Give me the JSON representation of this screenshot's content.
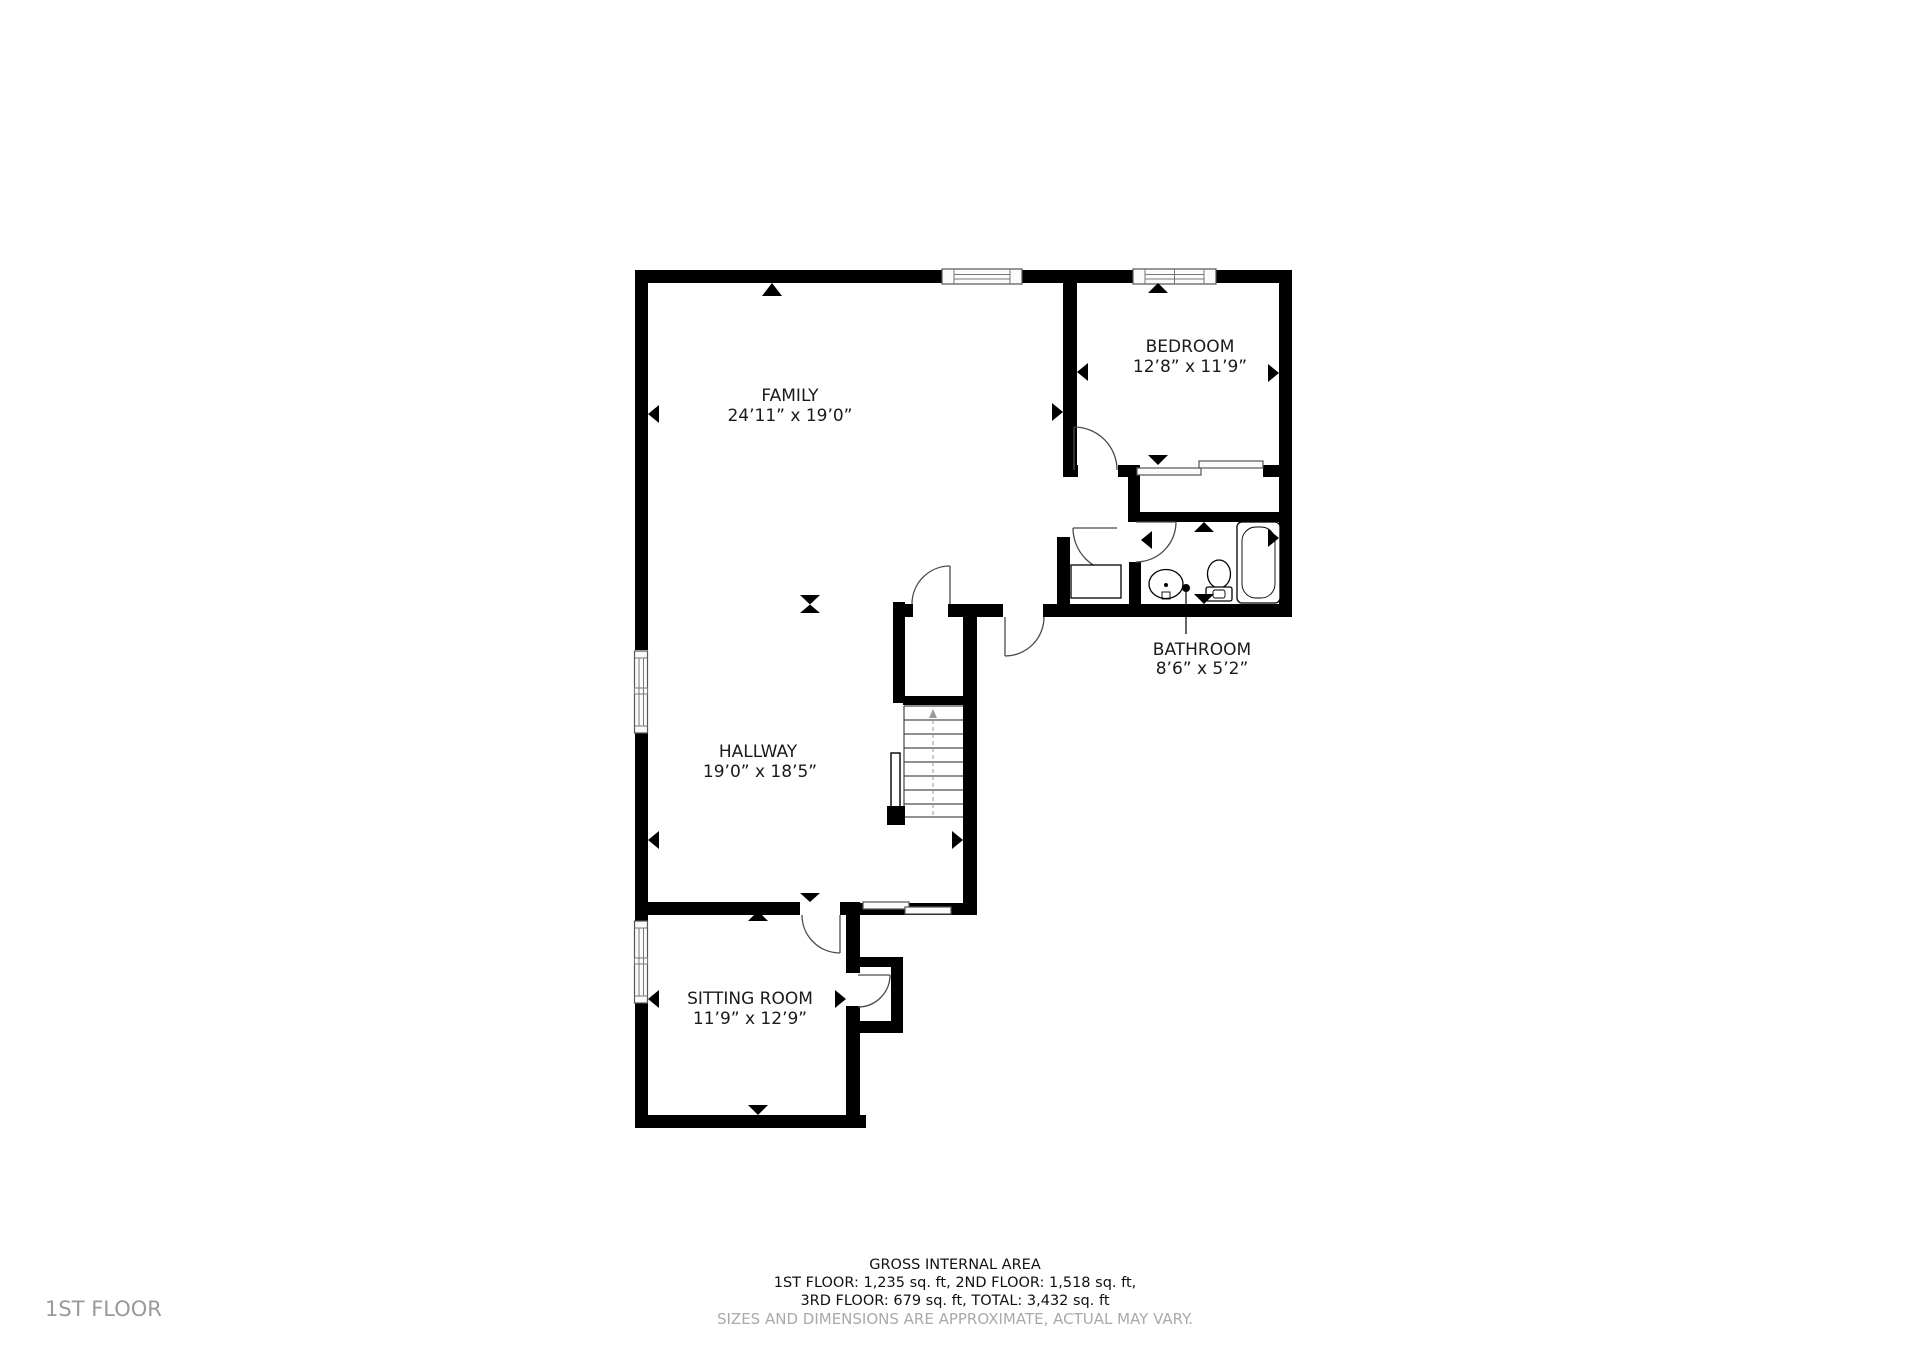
{
  "floor_label": "1ST FLOOR",
  "rooms": {
    "family": {
      "name": "FAMILY",
      "dims": "24’11” x 19’0”"
    },
    "bedroom": {
      "name": "BEDROOM",
      "dims": "12’8” x 11’9”"
    },
    "bathroom": {
      "name": "BATHROOM",
      "dims": "8’6” x 5’2”"
    },
    "hallway": {
      "name": "HALLWAY",
      "dims": "19’0” x 18’5”"
    },
    "sitting": {
      "name": "SITTING ROOM",
      "dims": "11’9” x 12’9”"
    }
  },
  "footer": {
    "line1": "GROSS INTERNAL AREA",
    "line2": "1ST FLOOR: 1,235 sq. ft, 2ND FLOOR: 1,518 sq. ft,",
    "line3": "3RD FLOOR: 679 sq. ft, TOTAL: 3,432 sq. ft",
    "disclaimer": "SIZES AND DIMENSIONS ARE APPROXIMATE, ACTUAL MAY VARY."
  },
  "colors": {
    "wall": "#000000",
    "door_arc": "#4a4a4a",
    "muted_text": "#a9a9a9",
    "label_text": "#1a1a1a"
  }
}
